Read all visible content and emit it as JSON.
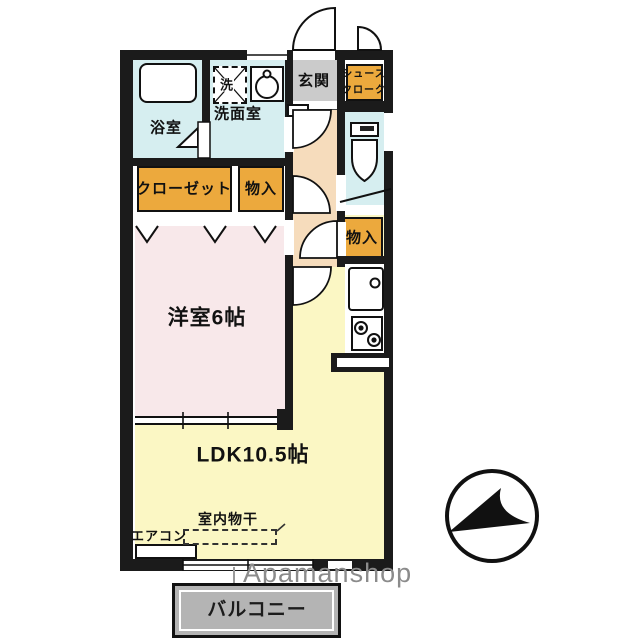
{
  "title": "1LDK apartment floor plan",
  "rooms": {
    "bath": "浴室",
    "washer_unit": "洗",
    "washroom": "洗面室",
    "entrance": "玄関",
    "shoe_closet_line1": "シュース",
    "shoe_closet_line2": "クローク",
    "closet": "クローゼット",
    "storage_upper": "物入",
    "storage_right": "物入",
    "western_room": "洋室6帖",
    "ldk": "LDK10.5帖",
    "indoor_drying": "室内物干",
    "aircon": "エアコン",
    "balcony": "バルコニー"
  },
  "watermark": "Apamanshop",
  "icons": [
    "bathtub-icon",
    "washing-machine-icon",
    "washbasin-icon",
    "toilet-icon",
    "kitchen-sink-icon",
    "stove-icon",
    "north-compass-icon"
  ],
  "colors": {
    "wall": "#1b1b1b",
    "water_room_cyan": "#d6eef0",
    "hall_beige": "#f6dcbc",
    "closet_orange": "#eca93d",
    "bedroom_pink": "#f8e8ea",
    "ldk_yellow": "#fbf7c4",
    "entrance_gray": "#cbcbcb",
    "balcony_gray": "#b4b4b4",
    "watermark_gray": "#8b8b8b"
  }
}
